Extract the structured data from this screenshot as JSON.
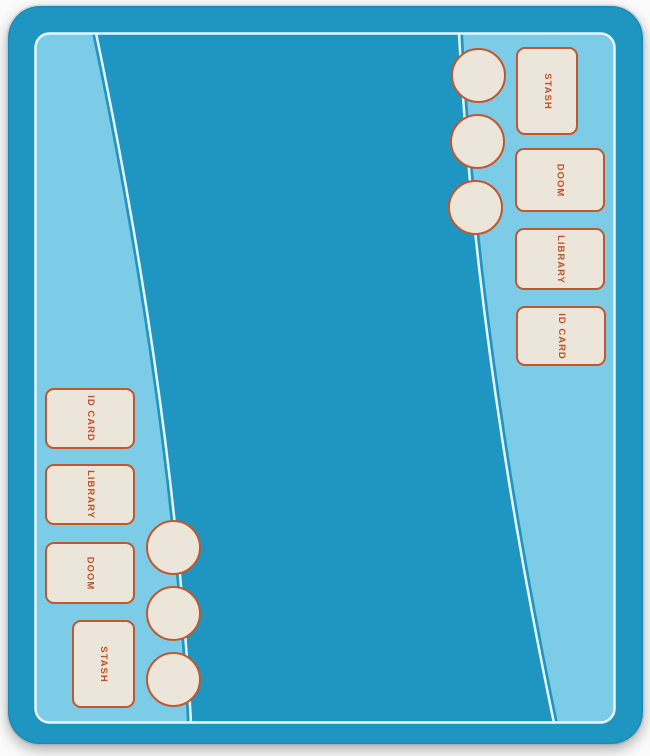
{
  "colors": {
    "field": "#1E96C1",
    "wedge": "#7CCBE7",
    "line": "#EAF5FA",
    "slot_fill": "#EBE6D9",
    "slot_border": "#C2572E",
    "label_text": "#BC5327"
  },
  "areas": {
    "top_right": {
      "player": "Player 2",
      "slots": [
        {
          "label": "STASH"
        },
        {
          "label": "DOOM"
        },
        {
          "label": "LIBRARY"
        },
        {
          "label": "ID CARD"
        }
      ],
      "token_spots": 3
    },
    "bottom_left": {
      "player": "Player 1",
      "slots": [
        {
          "label": "ID CARD"
        },
        {
          "label": "LIBRARY"
        },
        {
          "label": "DOOM"
        },
        {
          "label": "STASH"
        }
      ],
      "token_spots": 3
    }
  }
}
